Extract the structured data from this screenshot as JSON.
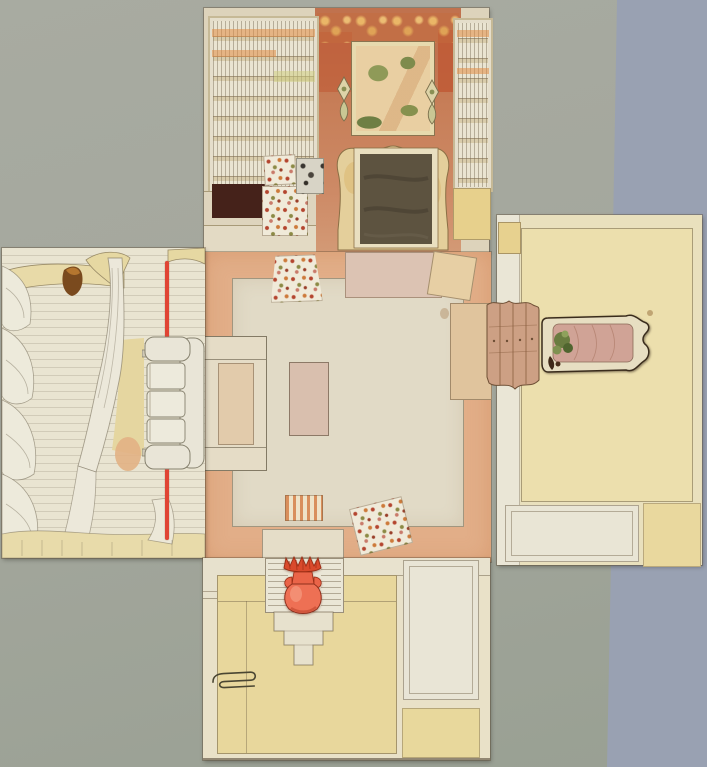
{
  "image": {
    "description": "Photograph of an unfolded watercolour paper maquette of a drawing-room interior, opened flat into a cross shape on grey cardboard",
    "type": "photograph of a paper model"
  },
  "background": {
    "surface": "blue-grey table surface",
    "board": "grey-green cardboard backing sheet"
  },
  "panels": {
    "back_wall": {
      "label": "chimney wall",
      "items": [
        "tall bookcase (left)",
        "narrow bookcase (right)",
        "gilt ornamental frieze",
        "landscape picture with trees",
        "wall sconce (left)",
        "wall sconce (right)",
        "cream rococo chimneypiece",
        "dark firebox",
        "dark cupboard opening",
        "floral chintz cut-outs",
        "pencil sketch scrap"
      ]
    },
    "left_wall": {
      "label": "window wall",
      "items": [
        "curtain valance",
        "stacked curtain swags",
        "tied-back curtain",
        "white sofa with three cushions",
        "red cord (upper)",
        "red cord (lower)",
        "brown blob stain",
        "fringed lower border"
      ]
    },
    "floor": {
      "label": "floor panel",
      "items": [
        "salmon floor border",
        "cream carpet",
        "hearth slab",
        "sofa footprint outline",
        "small table footprint",
        "floral seat cut-out (top)",
        "floral seat cut-out (bottom)",
        "plain tilted card",
        "beige side rectangle",
        "striped footstool piece",
        "paper flap over urn niche"
      ]
    },
    "right_wall": {
      "label": "panelled wall with pier glass",
      "items": [
        "large field panel",
        "white dado panel",
        "yellow dado panel",
        "white stile strip",
        "yellow corner tab",
        "chest of drawers cut-out",
        "pier-glass cut-out with pink drape and green plant"
      ]
    },
    "front_wall": {
      "label": "entrance wall with urn niche",
      "items": [
        "large yellow field panel",
        "white dado panel",
        "yellow dado square",
        "hatched niche",
        "stepped pedestal",
        "red urn with scalloped crown",
        "metal paper clip"
      ]
    }
  },
  "colors": {
    "bg_surface": "#99a1b2",
    "bg_board_light": "#a8aba1",
    "bg_board_mid": "#a4a79d",
    "bg_board_dark": "#99a093",
    "panel_cream": "#e9e4d1",
    "panel_back": "#ddd3bb",
    "panel_yellow": "#e9e0bd",
    "panel_front": "#e9e1c8",
    "floor_salmon": "#e2ae88",
    "carpet_cream": "#e1dac6",
    "hearth_pink": "#dcc3b3",
    "wall_terracotta": "#c77e58",
    "wall_red_patch": "#bf5a36",
    "frieze_gold": "#ecba68",
    "shelf_frame": "#c6b996",
    "shelf_cream": "#eae4d1",
    "shelf_orange": "#e0a061",
    "cabinet_maroon": "#45221a",
    "mantel_cream": "#e4cf9b",
    "firebox_brown": "#5d5340",
    "sofa_white": "#e9e5d7",
    "stripe_red": "#e04434",
    "curtain_yellow": "#e7d9a6",
    "commode_tan": "#cda084",
    "mirror_pink": "#d0a396",
    "plant_green": "#6a7c40",
    "vase_coral": "#ee7054",
    "vase_red": "#d94a2c",
    "pencil": "#8b8270"
  }
}
